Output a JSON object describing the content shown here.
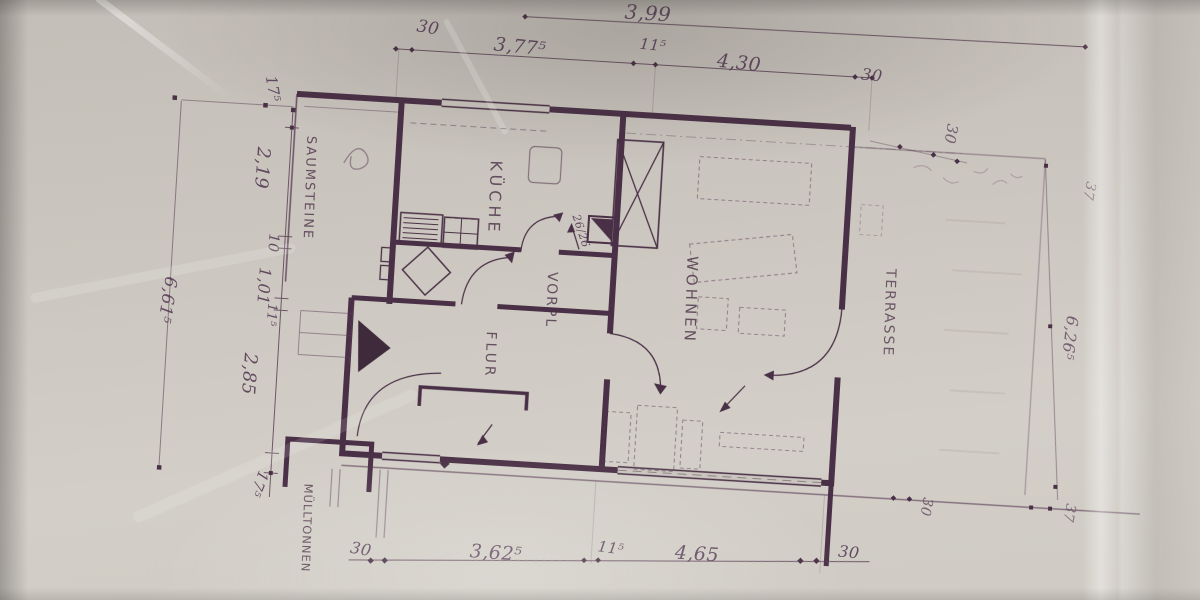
{
  "photo": {
    "description": "hand-drawn architectural floor plan photographed on creased paper, plan rotated 90 degrees",
    "ink_color": "#4a3046",
    "paper_color": "#cac5be"
  },
  "rooms": {
    "kueche": "KÜCHE",
    "vorplatz": "VORPL",
    "flur": "FLUR",
    "wohnen": "WOHNEN",
    "terrasse": "TERRASSE"
  },
  "site": {
    "saumsteine": "SAUMSTEINE",
    "muelltonnen": "MÜLLTONNEN"
  },
  "annotations": {
    "chimney": "26/26"
  },
  "dimensions": {
    "top": {
      "overall": "3,99",
      "seg30_left": "30",
      "seg377": "3,77⁵",
      "seg115": "11⁵",
      "seg430": "4,30",
      "seg30_right": "30"
    },
    "left": {
      "seg175_top": "17⁵",
      "seg219": "2,19",
      "seg10": "10",
      "seg101": "1,01",
      "seg115": "11⁵",
      "seg285": "2,85",
      "seg175_bottom": "17⁵",
      "overall": "6,61⁵"
    },
    "bottom": {
      "seg30_left": "30",
      "seg362": "3,62⁵",
      "seg115": "11⁵",
      "seg465": "4,65",
      "seg30_right": "30"
    },
    "right": {
      "seg30_top": "30",
      "seg37_top": "37",
      "overall": "6,26⁵",
      "seg30_bottom": "30",
      "seg37_bottom": "37"
    }
  }
}
